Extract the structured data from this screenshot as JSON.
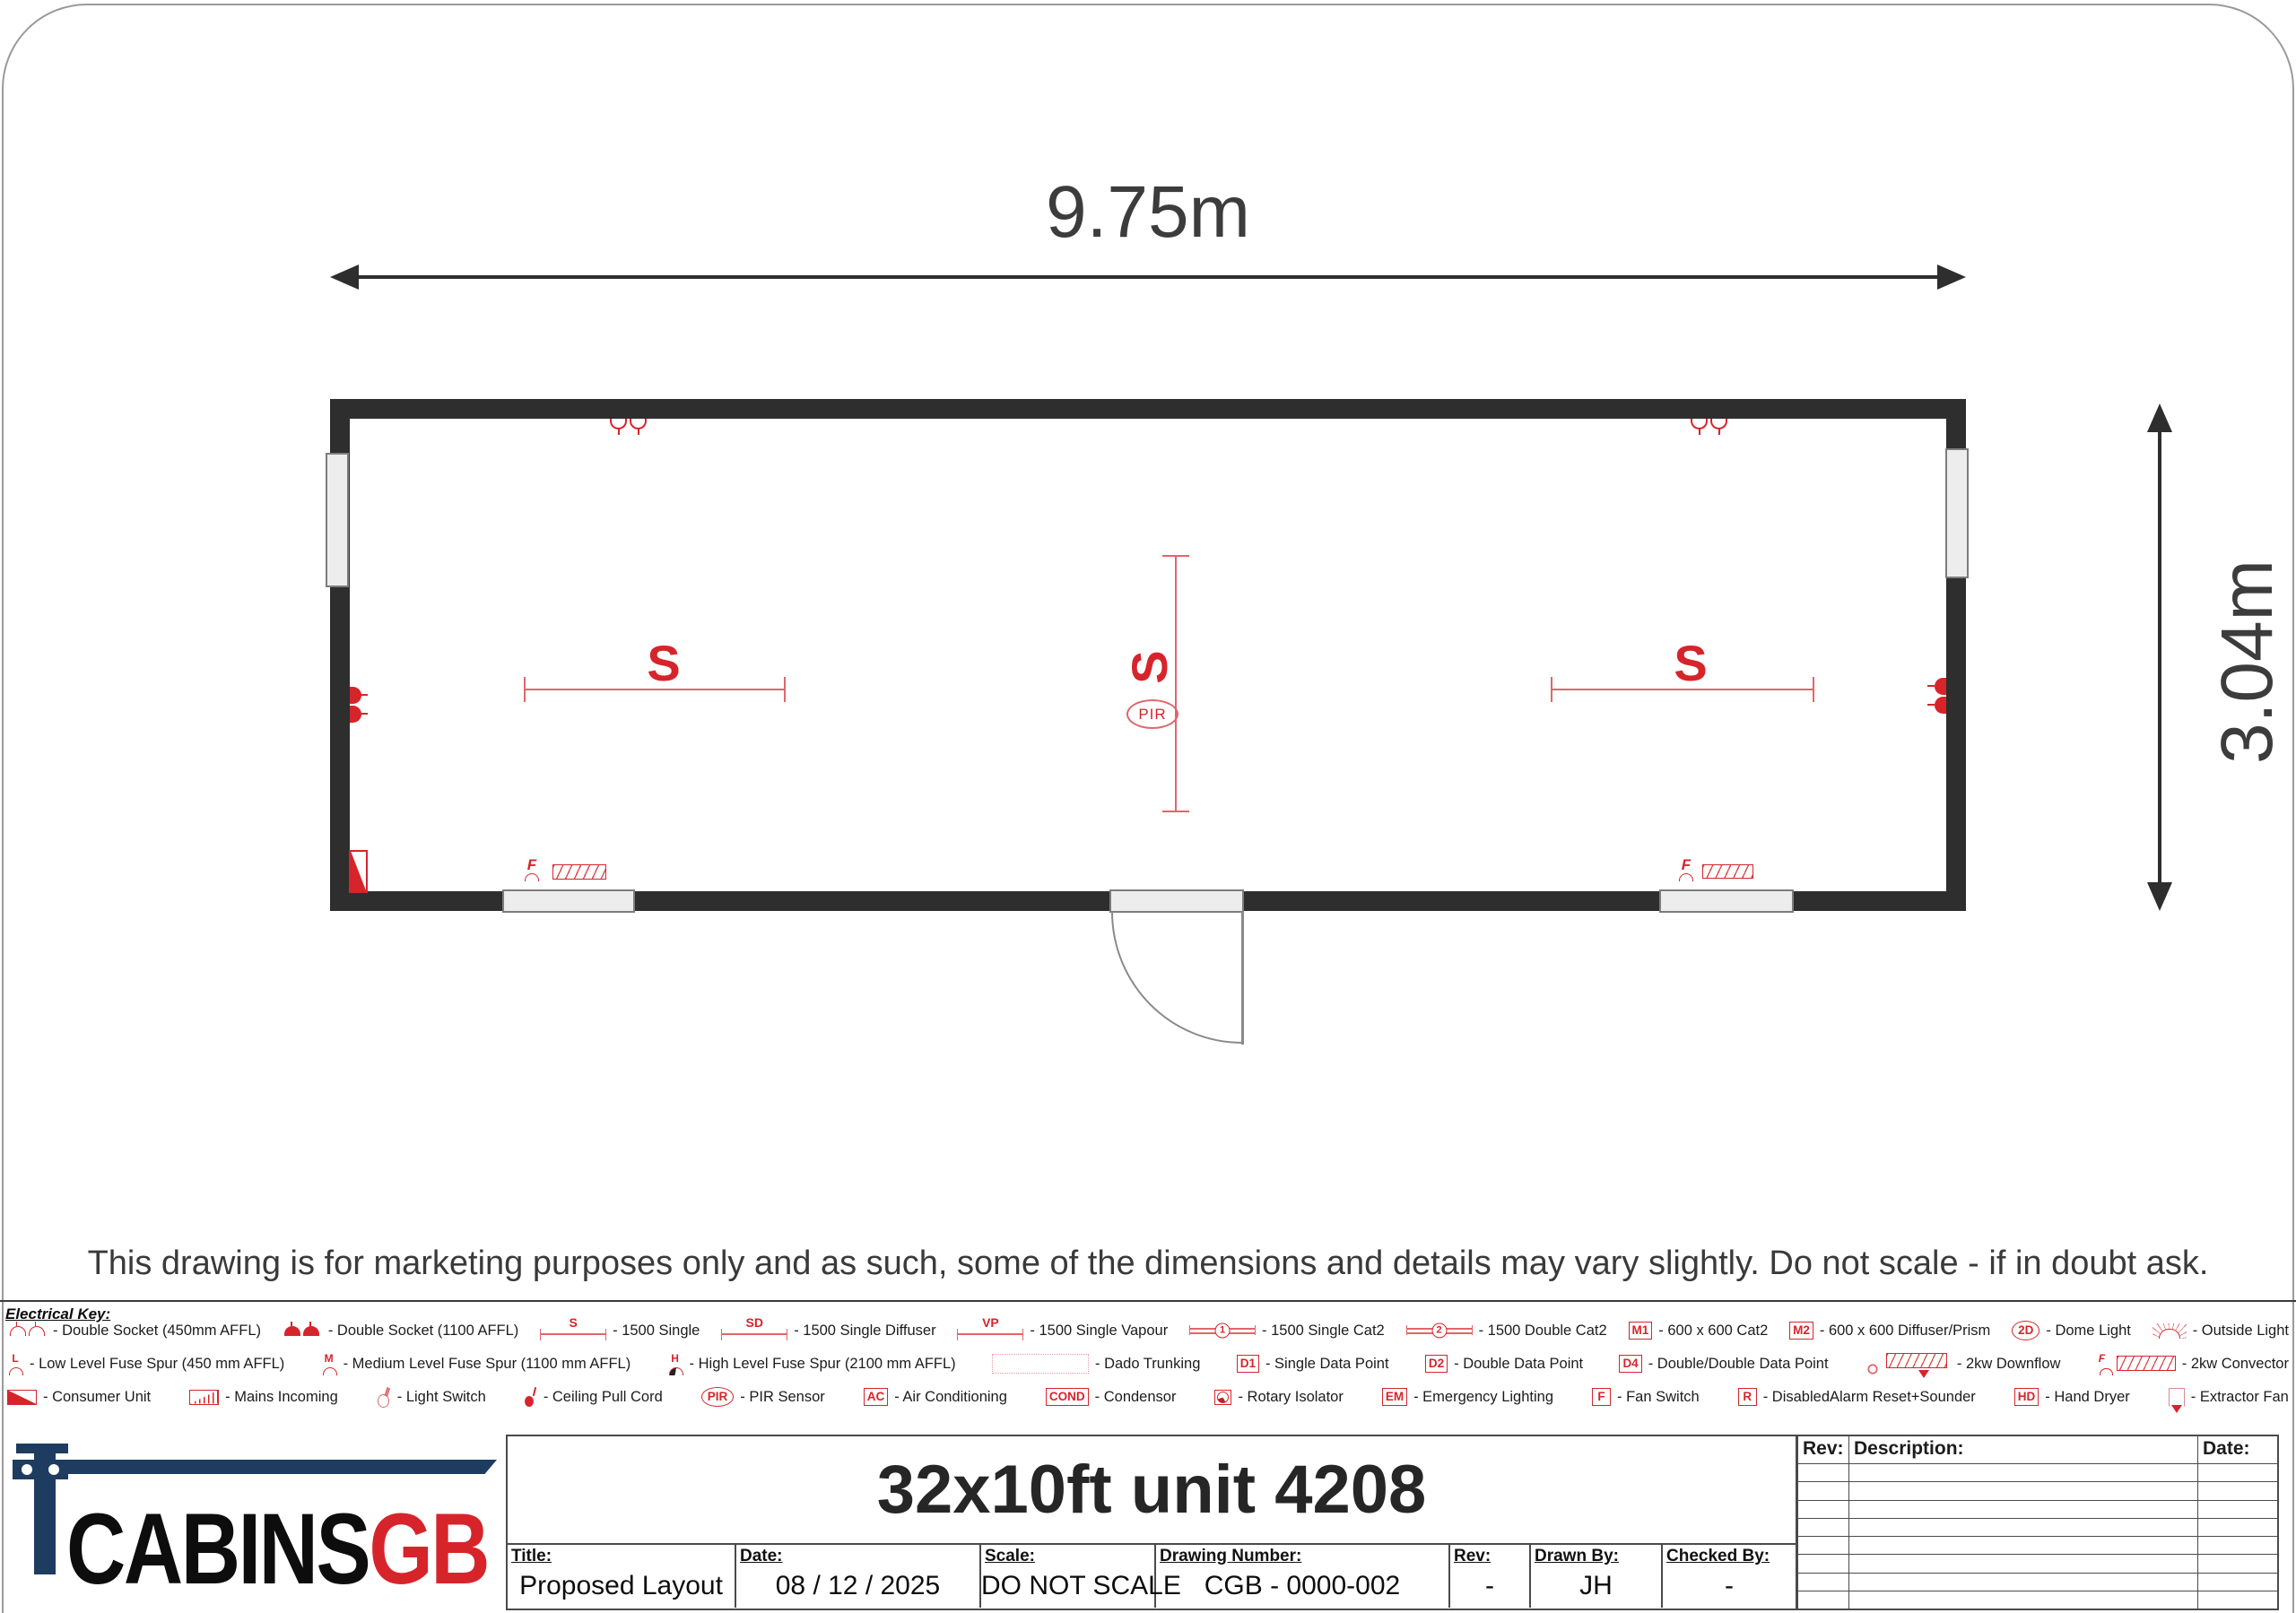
{
  "drawing": {
    "width_dim": "9.75m",
    "height_dim": "3.04m",
    "light_label": "S",
    "pir_label": "PIR",
    "fuse_label": "F",
    "disclaimer": "This drawing is for marketing purposes only and as such, some of the dimensions and details may vary slightly. Do not scale - if in doubt ask."
  },
  "colors": {
    "accent_red": "#d7242b",
    "wall": "#2e2e2e",
    "logo_navy": "#1e3c5f"
  },
  "electrical_key": {
    "heading": "Electrical Key:",
    "rows": [
      [
        {
          "sym": "k-socko",
          "icon": "double-socket-outline-icon",
          "label": "- Double Socket (450mm AFFL)"
        },
        {
          "sym": "k-sockf",
          "icon": "double-socket-filled-icon",
          "label": "- Double Socket (1100 AFFL)"
        },
        {
          "sym": "k-light",
          "icon": "light-1500-single-icon",
          "sym_label": "S",
          "label": "- 1500 Single"
        },
        {
          "sym": "k-light",
          "icon": "light-1500-single-diffuser-icon",
          "sym_label": "SD",
          "label": "- 1500 Single Diffuser"
        },
        {
          "sym": "k-light",
          "icon": "light-1500-single-vapour-icon",
          "sym_label": "VP",
          "label": "- 1500 Single Vapour"
        },
        {
          "sym": "k-cat2",
          "icon": "light-1500-single-cat2-icon",
          "sym_label": "1",
          "label": "- 1500 Single Cat2"
        },
        {
          "sym": "k-cat2",
          "icon": "light-1500-double-cat2-icon",
          "sym_label": "2",
          "label": "- 1500 Double Cat2"
        },
        {
          "sym": "k-box",
          "icon": "600x600-cat2-icon",
          "sym_label": "M1",
          "label": "- 600 x 600 Cat2"
        },
        {
          "sym": "k-box",
          "icon": "600x600-diffuser-prism-icon",
          "sym_label": "M2",
          "label": "- 600 x 600 Diffuser/Prism"
        },
        {
          "sym": "k-oval",
          "icon": "dome-light-icon",
          "sym_label": "2D",
          "label": "- Dome Light"
        },
        {
          "sym": "k-sun",
          "icon": "outside-light-icon",
          "label": "- Outside Light"
        }
      ],
      [
        {
          "sym": "k-fuse",
          "icon": "low-level-fuse-spur-icon",
          "sym_label": "L",
          "label": "- Low Level Fuse Spur (450 mm AFFL)"
        },
        {
          "sym": "k-fuse",
          "icon": "medium-level-fuse-spur-icon",
          "sym_label": "M",
          "label": "- Medium Level Fuse Spur (1100 mm AFFL)"
        },
        {
          "sym": "k-fuse dark",
          "icon": "high-level-fuse-spur-icon",
          "sym_label": "H",
          "label": "- High Level Fuse Spur (2100 mm AFFL)"
        },
        {
          "sym": "k-dado",
          "icon": "dado-trunking-icon",
          "label": "- Dado Trunking"
        },
        {
          "sym": "k-box",
          "icon": "single-data-point-icon",
          "sym_label": "D1",
          "label": "- Single Data Point"
        },
        {
          "sym": "k-box",
          "icon": "double-data-point-icon",
          "sym_label": "D2",
          "label": "- Double Data Point"
        },
        {
          "sym": "k-box",
          "icon": "double-double-data-point-icon",
          "sym_label": "D4",
          "label": "- Double/Double Data Point"
        },
        {
          "sym": "k-downflow",
          "icon": "downflow-heater-icon",
          "label": "- 2kw Downflow"
        },
        {
          "sym": "k-convector",
          "icon": "convector-heater-icon",
          "sym_label": "F",
          "label": "- 2kw Convector"
        }
      ],
      [
        {
          "sym": "k-consumer",
          "icon": "consumer-unit-icon",
          "label": "- Consumer Unit"
        },
        {
          "sym": "k-mains",
          "icon": "mains-incoming-icon",
          "label": "- Mains Incoming"
        },
        {
          "sym": "k-switch",
          "icon": "light-switch-icon",
          "label": "- Light Switch"
        },
        {
          "sym": "k-pull",
          "icon": "ceiling-pull-cord-icon",
          "label": "- Ceiling Pull Cord"
        },
        {
          "sym": "k-oval",
          "icon": "pir-sensor-icon",
          "sym_label": "PIR",
          "label": "- PIR Sensor"
        },
        {
          "sym": "k-box",
          "icon": "air-conditioning-icon",
          "sym_label": "AC",
          "label": "- Air Conditioning"
        },
        {
          "sym": "k-box",
          "icon": "condensor-icon",
          "sym_label": "COND",
          "label": "- Condensor"
        },
        {
          "sym": "k-rotary",
          "icon": "rotary-isolator-icon",
          "label": "- Rotary Isolator"
        },
        {
          "sym": "k-box",
          "icon": "emergency-lighting-icon",
          "sym_label": "EM",
          "label": "- Emergency Lighting"
        },
        {
          "sym": "k-box",
          "icon": "fan-switch-icon",
          "sym_label": "F",
          "label": "- Fan Switch"
        },
        {
          "sym": "k-box",
          "icon": "disabled-alarm-reset-sounder-icon",
          "sym_label": "R",
          "label": "- DisabledAlarm Reset+Sounder"
        },
        {
          "sym": "k-box",
          "icon": "hand-dryer-icon",
          "sym_label": "HD",
          "label": "- Hand Dryer"
        },
        {
          "sym": "k-extract",
          "icon": "extractor-fan-icon",
          "label": "- Extractor Fan"
        }
      ]
    ]
  },
  "title_block": {
    "logo": {
      "black": "CABINS",
      "red": "GB"
    },
    "drawing_title": "32x10ft unit 4208",
    "fields": [
      {
        "label": "Title:",
        "value": "Proposed Layout"
      },
      {
        "label": "Date:",
        "value": "08 / 12 / 2025"
      },
      {
        "label": "Scale:",
        "value": "DO NOT SCALE"
      },
      {
        "label": "Drawing Number:",
        "value": "CGB - 0000-002"
      },
      {
        "label": "Rev:",
        "value": "-"
      },
      {
        "label": "Drawn By:",
        "value": "JH"
      },
      {
        "label": "Checked By:",
        "value": "-"
      }
    ],
    "revision_table": {
      "headers": [
        "Rev:",
        "Description:",
        "Date:"
      ],
      "empty_rows": 8
    }
  }
}
